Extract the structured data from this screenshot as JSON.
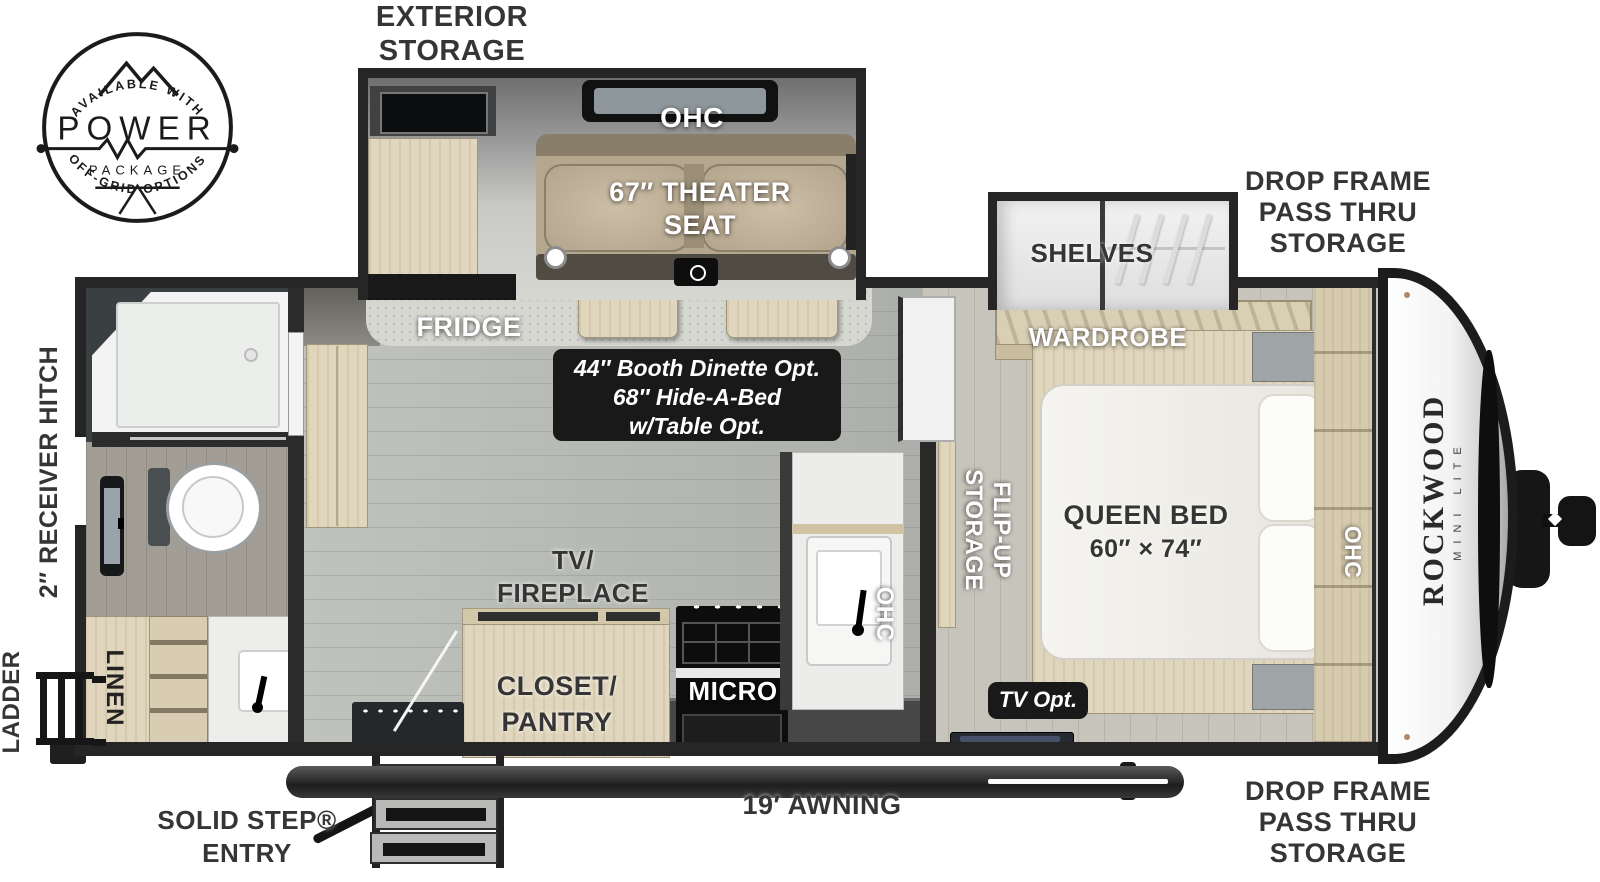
{
  "logo": {
    "arc_top": "AVAILABLE WITH",
    "word": "POWER",
    "word2": "PACKAGE",
    "arc_bottom": "OFF-GRID OPTIONS"
  },
  "labels": {
    "exterior_storage": [
      "EXTERIOR",
      "STORAGE"
    ],
    "drop_frame_top": [
      "DROP FRAME",
      "PASS THRU",
      "STORAGE"
    ],
    "drop_frame_bottom": [
      "DROP FRAME",
      "PASS THRU",
      "STORAGE"
    ],
    "ohc_slide": "OHC",
    "theater_seat": [
      "67″ THEATER",
      "SEAT"
    ],
    "shelves": "SHELVES",
    "wardrobe": "WARDROBE",
    "fridge": "FRIDGE",
    "dinette_badge": [
      "44″ Booth Dinette Opt.",
      "68″ Hide-A-Bed",
      "w/Table Opt."
    ],
    "receiver_hitch": "2″ RECEIVER HITCH",
    "ladder": "LADDER",
    "linen": "LINEN",
    "tv_fireplace": [
      "TV/",
      "FIREPLACE"
    ],
    "closet_pantry": [
      "CLOSET/",
      "PANTRY"
    ],
    "micro": "MICRO",
    "ohc_kitchen": "OHC",
    "flip_up_storage": [
      "FLIP-UP",
      "STORAGE"
    ],
    "queen_bed": [
      "QUEEN BED",
      "60″ × 74″"
    ],
    "tv_opt": "TV Opt.",
    "ohc_bedroom": "OHC",
    "brand_name": "ROCKWOOD",
    "brand_sub": "MINI LITE",
    "solid_step": [
      "SOLID STEP®",
      "ENTRY"
    ],
    "awning": "19′ AWNING"
  },
  "colors": {
    "wall": "#262626",
    "wood": "#e0d6bd",
    "floor_living": "#b7bab4",
    "floor_bedroom": "#c7c4bb",
    "theater_tan": "#b5a68e",
    "badge_bg": "#191919",
    "text_dark": "#353535",
    "text_white": "#ffffff"
  }
}
